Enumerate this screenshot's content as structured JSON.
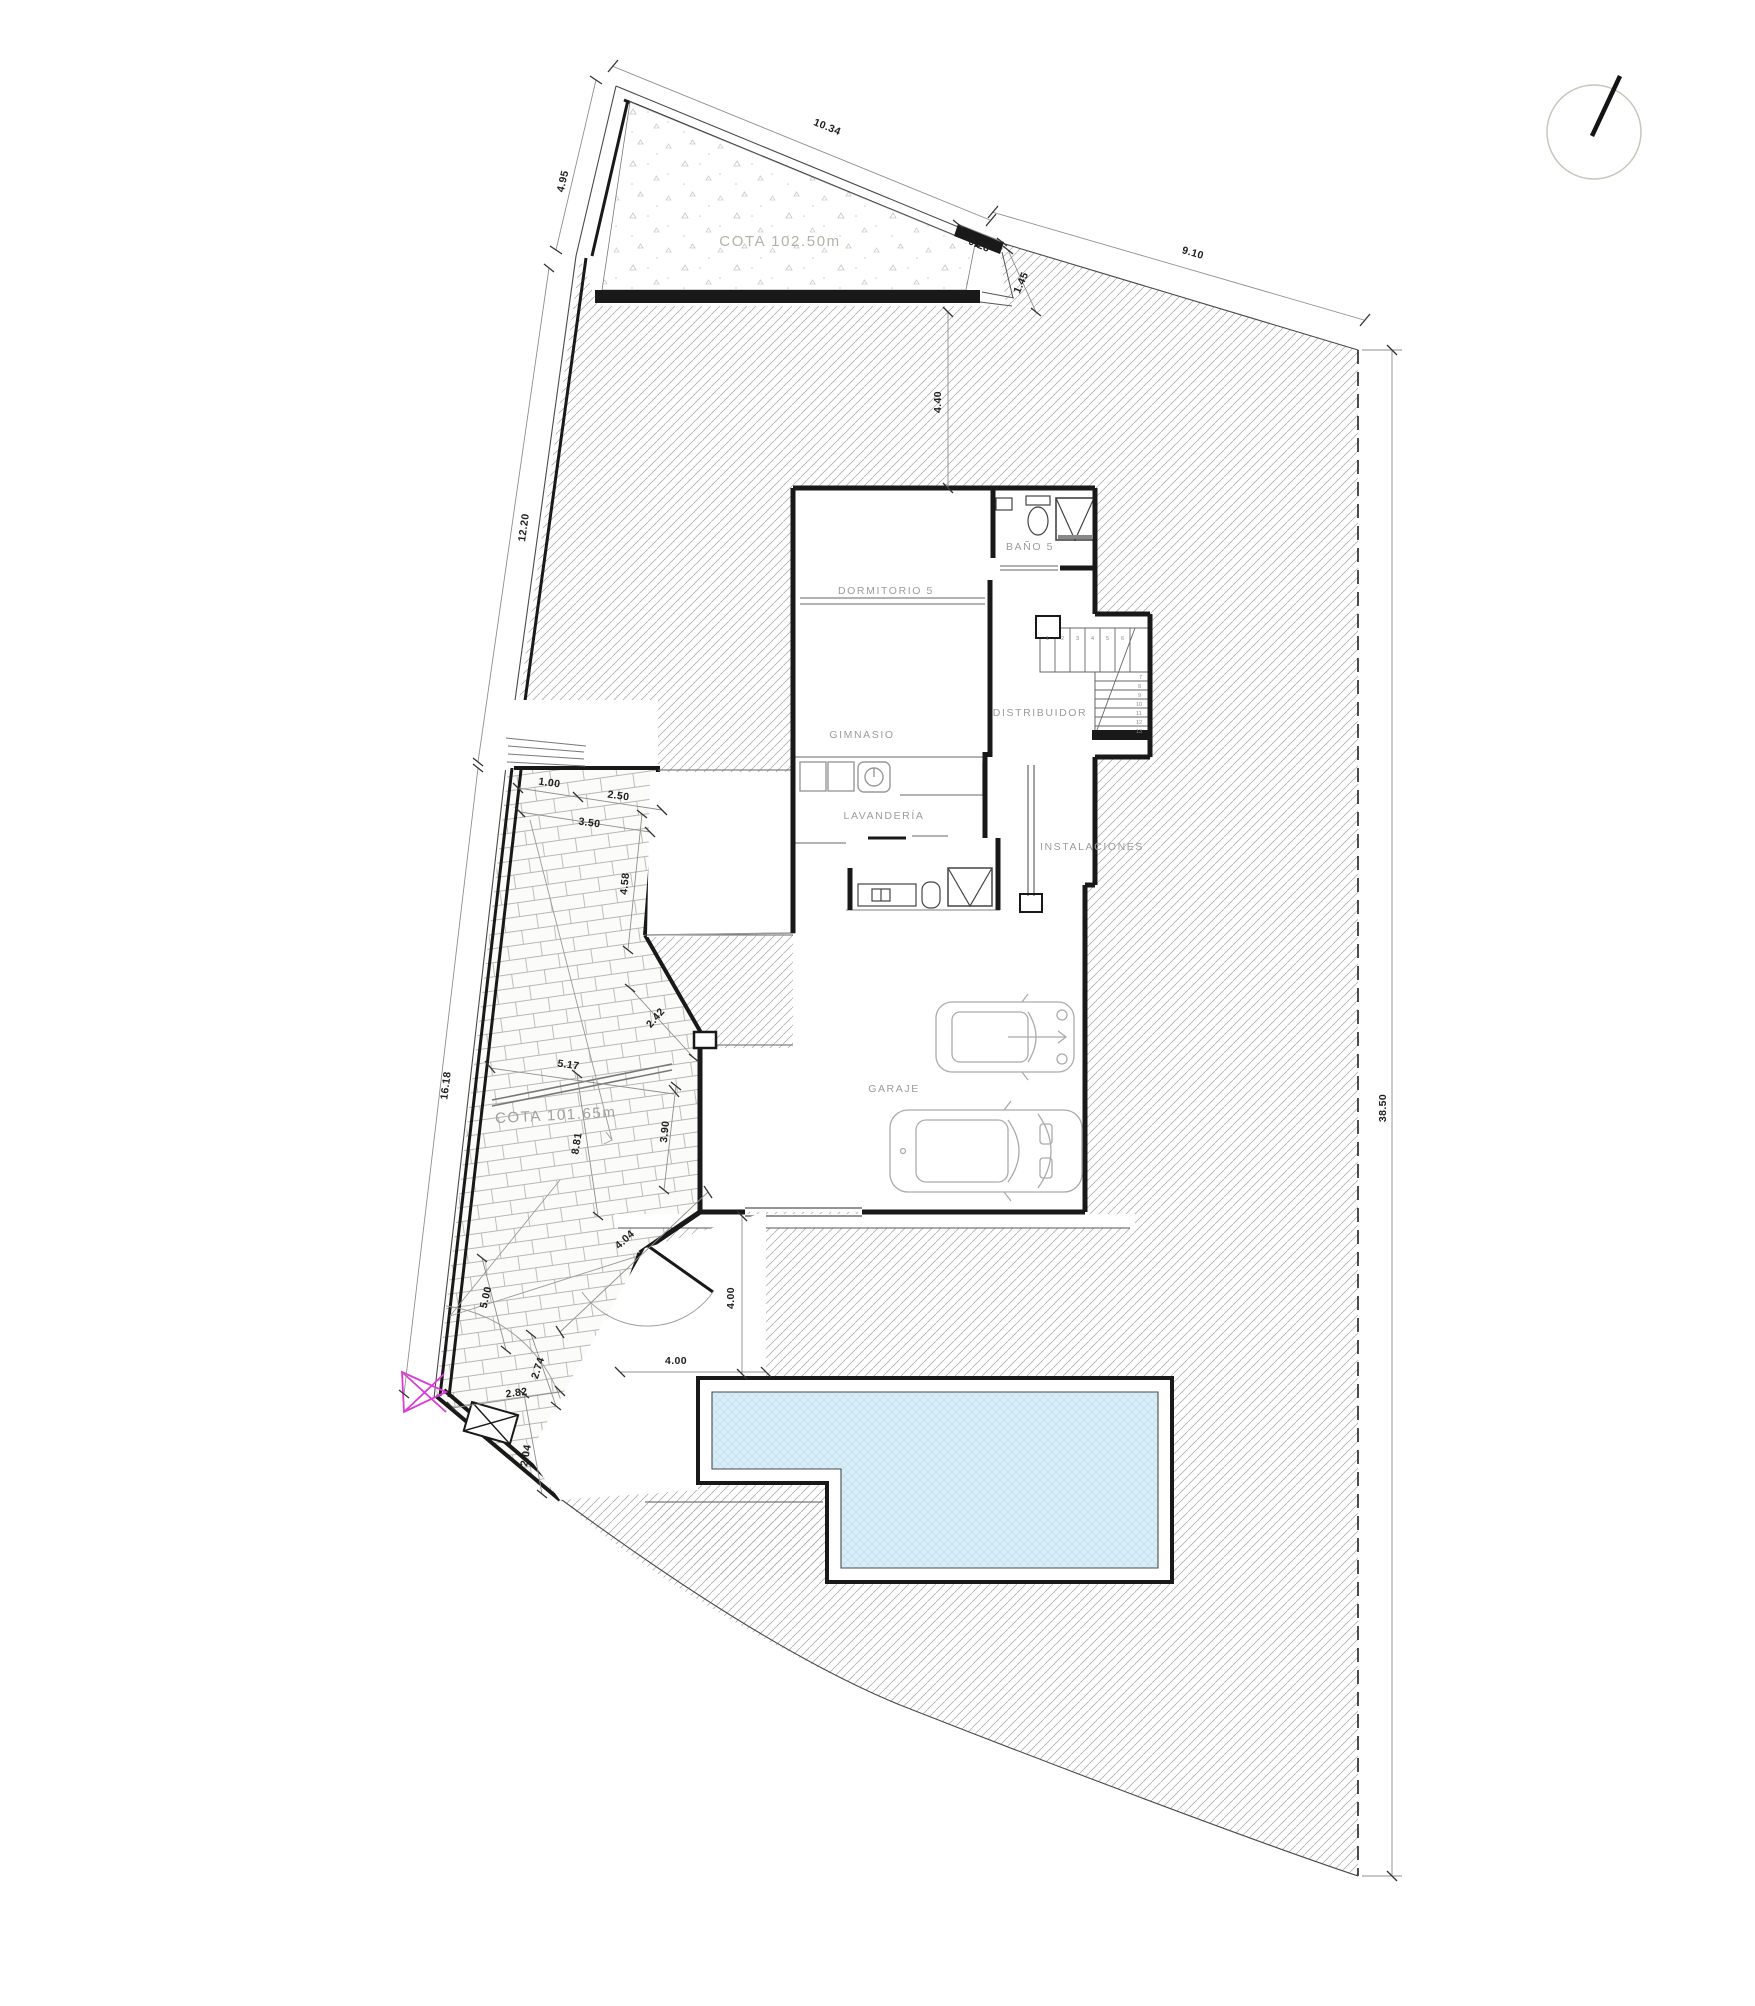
{
  "levels": {
    "upper_terrace": "COTA 102.50m",
    "lower_terrace": "COTA 101.65m"
  },
  "rooms": {
    "dormitorio5": "DORMITORIO 5",
    "bano5": "BAÑO 5",
    "gimnasio": "GIMNASIO",
    "distribuidor": "DISTRIBUIDOR",
    "lavanderia": "LAVANDERÍA",
    "instalaciones": "INSTALACIONES",
    "garaje": "GARAJE"
  },
  "dimensions": {
    "top_edge_upper": "10.34",
    "left_edge_top": "4.95",
    "step_depth": "0.28",
    "step_length": "1.45",
    "top_edge_right": "9.10",
    "garden_depth": "4.40",
    "left_edge_mid": "12.20",
    "terrace_stair_width": "1.00",
    "terrace_top_width": "2.50",
    "terrace_upper_width": "3.50",
    "terrace_upper_length": "4.58",
    "left_edge_lower": "16.18",
    "terrace_mid_width": "5.17",
    "terrace_lower_length": "8.81",
    "courtyard_length": "3.90",
    "courtyard_wall": "2.42",
    "terrace_end_length": "5.00",
    "entry_path_length": "4.04",
    "terrace_tip_length": "2.74",
    "terrace_tip_width": "2.82",
    "boundary_end": "2.04",
    "entry_depth": "4.00",
    "entry_width": "4.00",
    "right_edge": "38.50"
  },
  "stairs": {
    "treads": [
      "1",
      "2",
      "3",
      "4",
      "5",
      "6",
      "7",
      "8",
      "9",
      "10",
      "11",
      "12",
      "13"
    ]
  },
  "colors": {
    "pool_water": "#d8edf8",
    "pool_hatch": "#b9dcec",
    "marker": "#da3bd8",
    "walls": "#191919",
    "hatch_line": "#b0b0b0",
    "label_gray": "#9c9c9c"
  }
}
